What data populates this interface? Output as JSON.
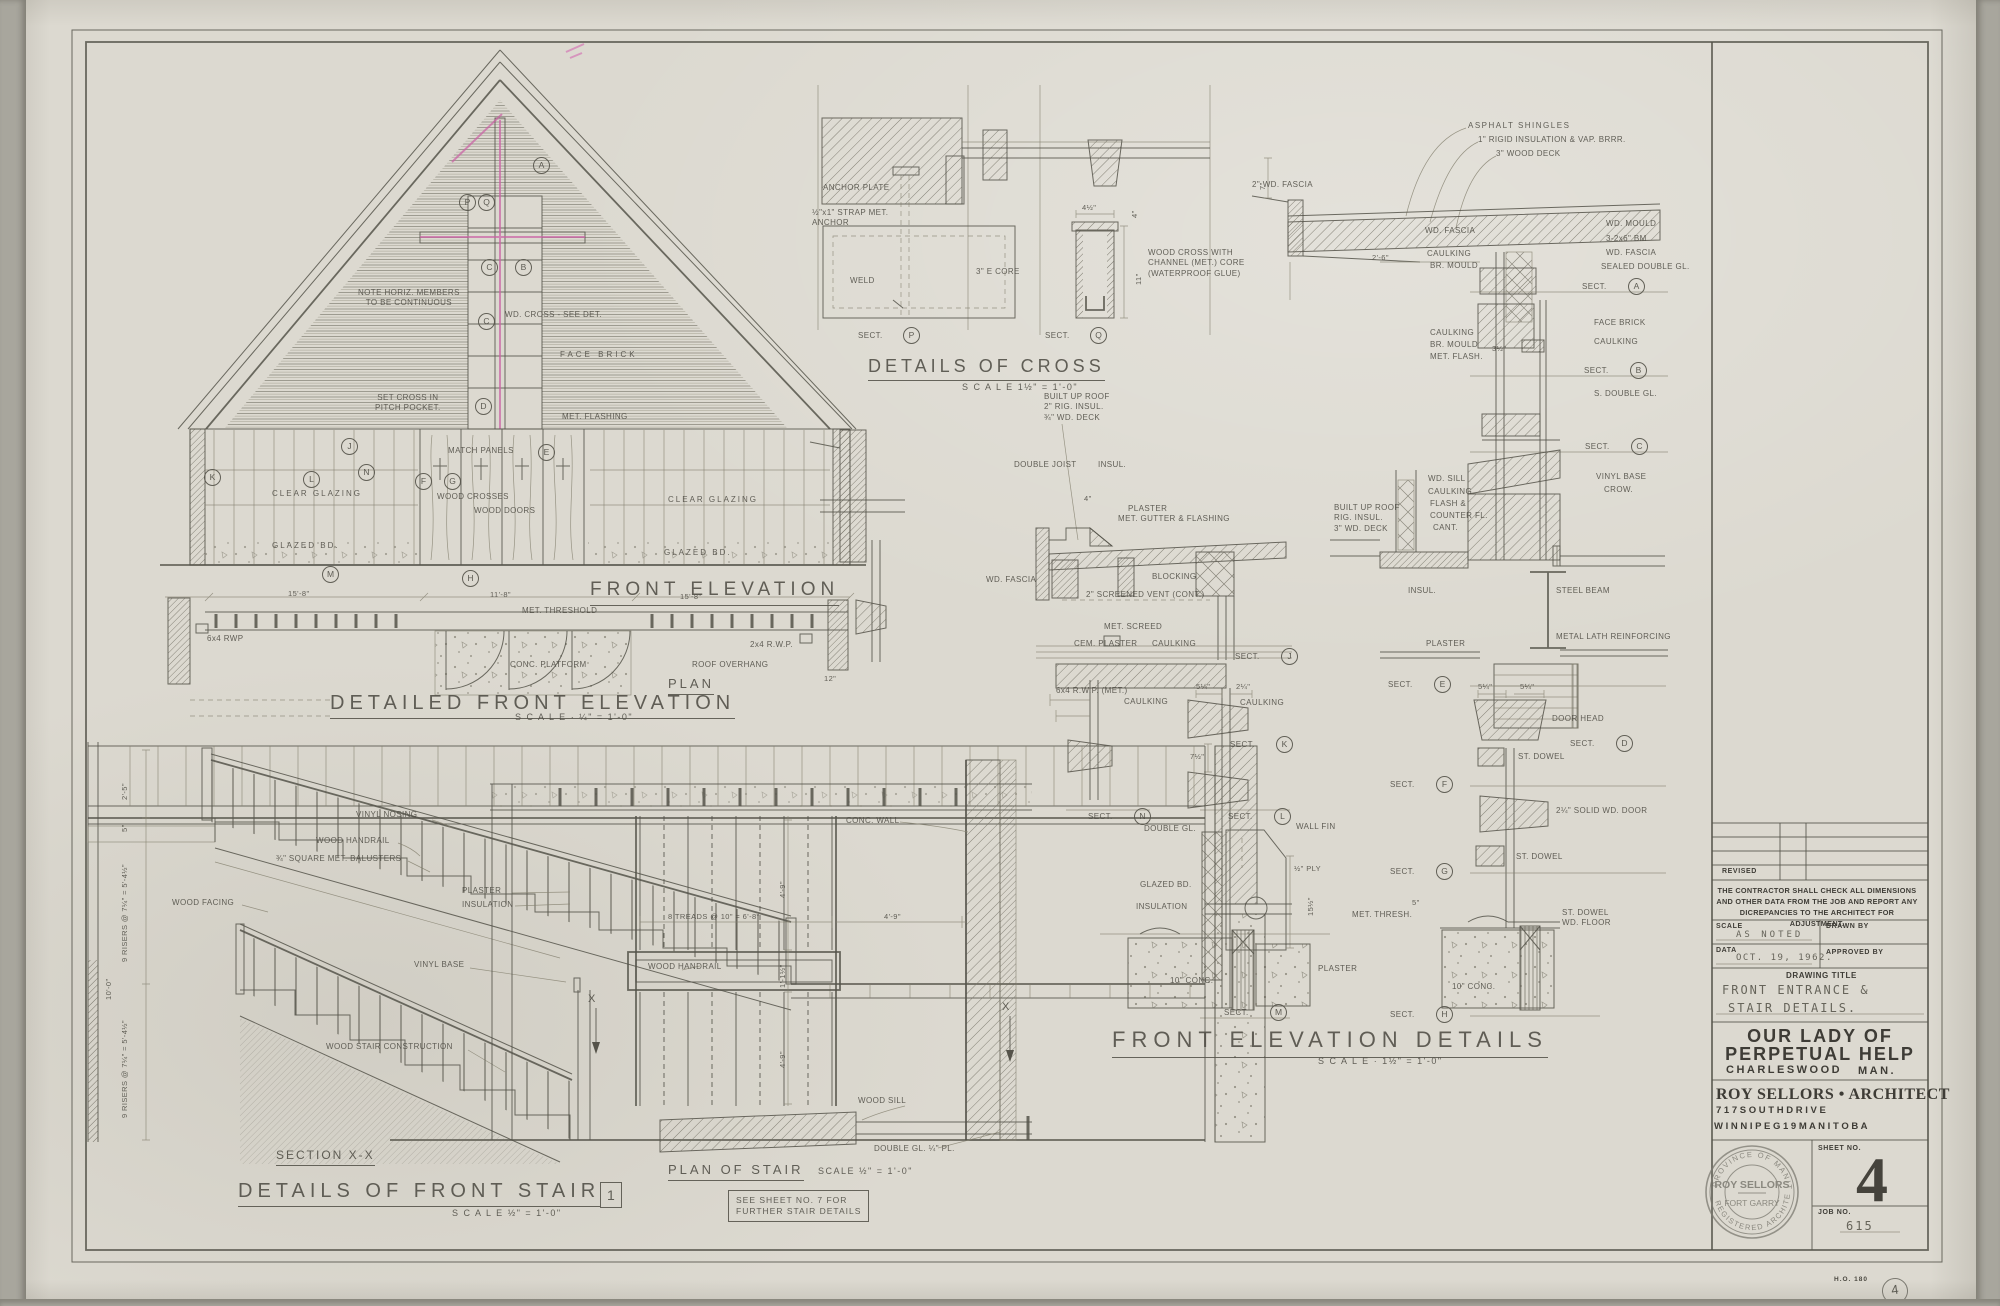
{
  "common": {
    "sect": "SECT."
  },
  "front_elevation": {
    "title": "FRONT ELEVATION",
    "note_continuous": "NOTE HORIZ. MEMBERS\nTO BE CONTINUOUS",
    "wd_cross_note": "WD. CROSS - SEE DET.",
    "face_brick": "FACE BRICK",
    "set_cross_note": "SET CROSS IN\nPITCH POCKET.",
    "met_flashing": "MET. FLASHING",
    "match_panels": "MATCH PANELS",
    "clear_glazing": "CLEAR GLAZING",
    "wood_crosses": "WOOD CROSSES",
    "wood_doors": "WOOD DOORS",
    "glazed_bd": "GLAZED BD.",
    "markers": {
      "a": "A",
      "p": "P",
      "q": "Q",
      "c1": "C",
      "b": "B",
      "c2": "C",
      "d": "D",
      "e": "E",
      "j": "J",
      "k": "K",
      "l": "L",
      "n": "N",
      "m": "M",
      "f": "F",
      "g": "G",
      "h": "H"
    }
  },
  "plan_elevation": {
    "detailed_title": "DETAILED FRONT ELEVATION",
    "detailed_scale": "S C A L E · ¼\" = 1'-0\"",
    "plan_title": "PLAN",
    "met_threshold": "MET. THRESHOLD",
    "conc_platform": "CONC. PLATFORM",
    "roof_overhang": "ROOF OVERHANG",
    "rwp_left": "6x4 RWP",
    "rwp_right": "2x4 R.W.P.",
    "dim_15_8": "15'-8\"",
    "dim_11_8": "11'-8\"",
    "dim_12": "12\""
  },
  "cross_details": {
    "title": "DETAILS OF CROSS",
    "scale": "S C A L E  1½\" = 1'-0\"",
    "anchor_plate": "ANCHOR PLATE",
    "strap_anchor": "½\"x1\" STRAP MET.\nANCHOR",
    "weld": "WELD",
    "core": "3\" E CORE",
    "wood_cross_note": "WOOD CROSS WITH\nCHANNEL (MET.) CORE\n(WATERPROOF GLUE)",
    "dim_4_5": "4½\"",
    "dim_4": "4\"",
    "dim_11": "11\"",
    "sections": {
      "p": "P",
      "q": "Q"
    }
  },
  "roof_details": {
    "asphalt": "ASPHALT SHINGLES",
    "rigid_insul": "1\" RIGID INSULATION & VAP. BRRR.",
    "wood_deck": "3\" WOOD DECK",
    "dim_7": "7\"",
    "wd_fascia_2": "2\" WD. FASCIA",
    "wd_fascia": "WD. FASCIA",
    "caulking": "CAULKING",
    "br_mould": "BR. MOULD",
    "dim_2_6": "2'-6\"",
    "wd_mould": "WD. MOULD",
    "beam": "3-2x6\" BM",
    "sealed_double": "SEALED DOUBLE GL.",
    "face_brick": "FACE BRICK",
    "met_flash": "MET. FLASH.",
    "s_double_gl": "S. DOUBLE GL.",
    "dim_3_5": "3½\"",
    "wd_sill": "WD. SILL",
    "flash": "FLASH &",
    "counter_fl": "COUNTER FL.",
    "cant": "CANT.",
    "vinyl_base": "VINYL BASE",
    "crow": "CROW.",
    "built_up": "BUILT UP ROOF\nRIG. INSUL.\n3\" WD. DECK",
    "insul": "INSUL.",
    "steel_beam": "STEEL BEAM",
    "metal_lath": "METAL LATH REINFORCING",
    "plaster": "PLASTER",
    "sections": {
      "a": "A",
      "b": "B",
      "c": "C",
      "d": "D"
    }
  },
  "center_details": {
    "title": "FRONT ELEVATION DETAILS",
    "scale": "S C A L E · 1½\" = 1'-0\"",
    "dim_4": "4\"",
    "met_gutter": "MET. GUTTER & FLASHING",
    "wd_fascia": "WD. FASCIA",
    "blocking": "BLOCKING",
    "vent": "2\" SCREENED VENT (CONT.)",
    "met_screed": "MET. SCREED",
    "cem_plaster": "CEM. PLASTER",
    "caulking": "CAULKING",
    "rwp": "6x4 R.W.P. (MET.)",
    "built_up": "BUILT UP ROOF\n2\" RIG. INSUL.\n¾\" WD. DECK",
    "double_joist": "DOUBLE JOIST",
    "insul": "INSUL.",
    "plaster": "PLASTER",
    "double_gl": "DOUBLE GL.",
    "wall_fin": "WALL FIN",
    "ply": "½\" PLY",
    "glazed_bd": "GLAZED BD.",
    "insulation": "INSULATION",
    "conc_10": "10\" CONC.",
    "dim_5_25": "5¼\"",
    "dim_2_25": "2¼\"",
    "dim_7_5": "7½\"",
    "dim_15_5": "15½\"",
    "sections": {
      "j": "J",
      "k": "K",
      "l": "L",
      "n": "N",
      "m": "M"
    }
  },
  "door_details": {
    "dim_5_25": "5¼\"",
    "door_head": "DOOR HEAD",
    "st_dowel": "ST. DOWEL",
    "solid_door": "2¼\" SOLID WD. DOOR",
    "dim_5": "5\"",
    "met_thresh": "MET. THRESH.",
    "st_dowel_floor": "ST. DOWEL\nWD. FLOOR",
    "conc_10": "10\" CONC.",
    "sections": {
      "e": "E",
      "f": "F",
      "g": "G",
      "h": "H"
    }
  },
  "stair_section": {
    "title": "SECTION X-X",
    "vinyl_nosing": "VINYL NOSING",
    "wood_handrail": "WOOD HANDRAIL",
    "balusters": "¾\" SQUARE MET. BALUSTERS",
    "wood_facing": "WOOD FACING",
    "plaster": "PLASTER",
    "insulation": "INSULATION",
    "vinyl_base": "VINYL BASE",
    "wood_stair": "WOOD STAIR CONSTRUCTION",
    "dim_2_5": "2'-5\"",
    "dim_5": "5\"",
    "risers_a": "9 RISERS @ 7¼\" = 5'-4½\"",
    "dim_10_0": "10'-0\"",
    "risers_b": "9 RISERS @ 7¼\" = 5'-4½\""
  },
  "stair_details_title": {
    "title": "DETAILS OF FRONT STAIR",
    "number": "1",
    "scale": "S C A L E  ½\" = 1'-0\"",
    "note": "SEE SHEET NO. 7 FOR\nFURTHER STAIR DETAILS"
  },
  "stair_plan": {
    "title": "PLAN OF STAIR",
    "scale": "SCALE ½\" = 1'-0\"",
    "conc_wall": "CONC. WALL",
    "wood_handrail": "WOOD HANDRAIL",
    "treads": "8 TREADS @ 10\" = 6'-8\"",
    "dim_4_9": "4'-9\"",
    "dim_1_1": "1'-1½\"",
    "wood_sill": "WOOD SILL",
    "double_gl": "DOUBLE GL. ¼\" PL.",
    "x_mark": "X"
  },
  "title_block": {
    "revised_label": "REVISED",
    "note": "THE CONTRACTOR SHALL CHECK ALL DIMENSIONS AND OTHER DATA FROM THE JOB AND REPORT ANY DICREPANCIES TO THE ARCHITECT FOR ADJUSTMENT.",
    "scale_label": "SCALE",
    "scale_value": "AS NOTED",
    "drawn_by_label": "DRAWN BY",
    "date_label": "DATA",
    "date_value": "OCT. 19, 1962.",
    "approved_by_label": "APPROVED BY",
    "drawing_title_label": "DRAWING TITLE",
    "drawing_title_line1": "FRONT ENTRANCE &",
    "drawing_title_line2": "STAIR DETAILS.",
    "project_line1": "OUR LADY OF",
    "project_line2": "PERPETUAL HELP",
    "project_city": "CHARLESWOOD",
    "project_prov": "MAN.",
    "architect": "ROY SELLORS • ARCHITECT",
    "architect_addr1": "7 1 7   S O U T H   D R I V E",
    "architect_addr2": "W I N N I P E G   1 9   M A N I T O B A",
    "sheet_no_label": "SHEET NO.",
    "sheet_no": "4",
    "job_no_label": "JOB NO.",
    "job_no": "615",
    "stamp": {
      "arc_top": "PROVINCE OF MANITOBA",
      "name": "ROY SELLORS",
      "middle": "FORT GARRY",
      "arc_bottom": "REGISTERED ARCHITECT"
    }
  },
  "sheet_footer": {
    "print_code": "H.O. 180",
    "corner_mark": "4"
  }
}
